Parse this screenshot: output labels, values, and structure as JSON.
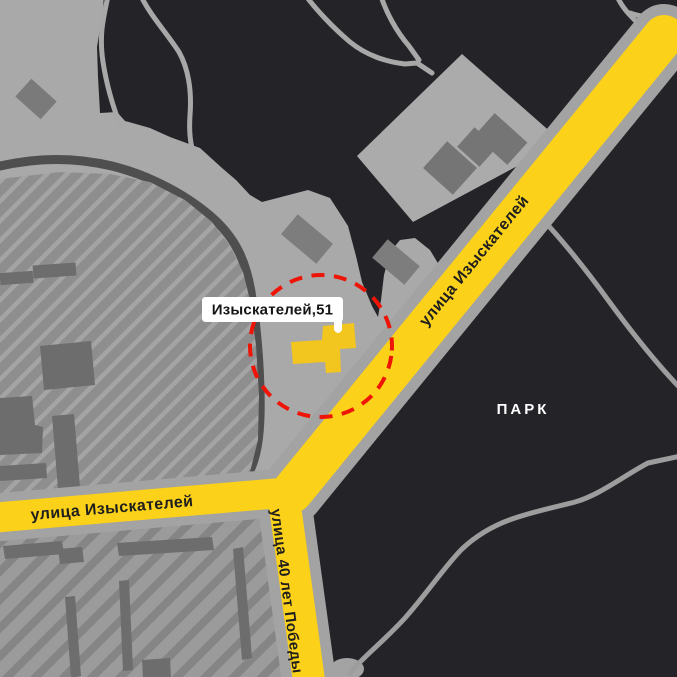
{
  "map": {
    "address_marker": {
      "label": "Изыскателей,51"
    },
    "streets": {
      "izyskateley_diagonal": "улица Изыскателей",
      "izyskateley_west": "улица Изыскателей",
      "pobedy_40_let": "улица 40 лет Победы"
    },
    "areas": {
      "park": "ПАРК"
    },
    "colors": {
      "background": "#a9a9a9",
      "land_dark": "#242428",
      "road_yellow": "#fbd119",
      "road_casing": "#a3a3a3",
      "path_gray": "#9d9d9d",
      "ring_dark": "#4f4f4f",
      "stadium_base": "#8e8e8e",
      "stadium_stripe": "#a4a4a4",
      "block_light": "#9b9b9b",
      "block_dark": "#858585",
      "building_gray": "#6d6d6d",
      "building_midgray": "#7d7d7d",
      "square_light": "#ababab",
      "building_highlight": "#f2c51f",
      "highlight_red": "#ee1506",
      "label_bg": "#ffffff",
      "label_text": "#151515",
      "street_text": "#1e1e1e",
      "park_text": "#ffffff"
    }
  }
}
